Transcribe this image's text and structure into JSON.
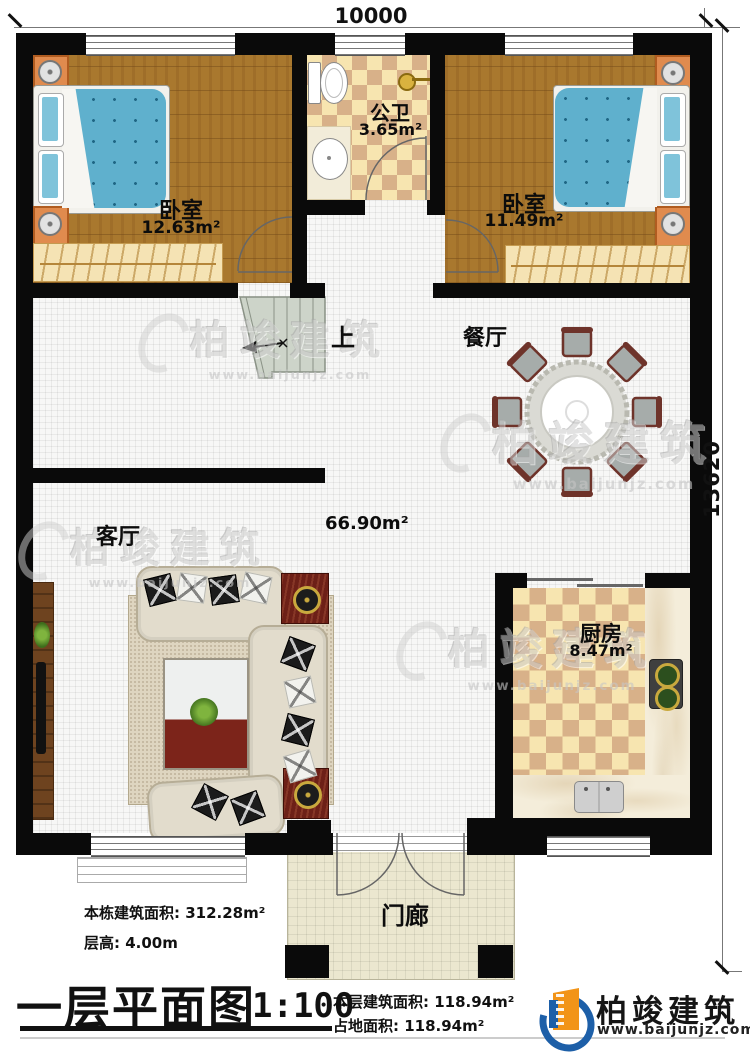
{
  "dimensions": {
    "width_top": "10000",
    "height_right": "13620"
  },
  "rooms": {
    "bedroom_left": {
      "name": "卧室",
      "area": "12.63m²"
    },
    "bathroom": {
      "name": "公卫",
      "area": "3.65m²"
    },
    "bedroom_right": {
      "name": "卧室",
      "area": "11.49m²"
    },
    "dining": {
      "name": "餐厅"
    },
    "living": {
      "name": "客厅",
      "area": "66.90m²"
    },
    "kitchen": {
      "name": "厨房",
      "area": "8.47m²"
    },
    "porch": {
      "name": "门廊"
    },
    "stairs": {
      "direction": "上"
    }
  },
  "info_block": {
    "total_area_label": "本栋建筑面积: ",
    "total_area": "312.28m²",
    "floor_height_label": "层高: ",
    "floor_height": "4.00m"
  },
  "title_block": {
    "title": "一层平面图",
    "scale": "1:100",
    "floor_area_label": "本层建筑面积: ",
    "floor_area": "118.94m²",
    "footprint_label": "占地面积: ",
    "footprint": "118.94m²"
  },
  "brand": {
    "name": "柏竣建筑",
    "website": "www.baijunjz.com"
  },
  "watermark": {
    "name": "柏竣建筑",
    "website": "www.baijunjz.com"
  },
  "colors": {
    "wall": "#0a0a0a",
    "wood_floor": "#a9782e",
    "checker_dark": "#d8b189",
    "checker_light": "#f7e5b0",
    "tile": "#f7f7f6",
    "porch_tile": "#ebe7cf",
    "bed_blue": "#5fb0cd",
    "table_red": "#6d2017",
    "brand_blue": "#1d5fa8",
    "brand_orange": "#f29418"
  }
}
